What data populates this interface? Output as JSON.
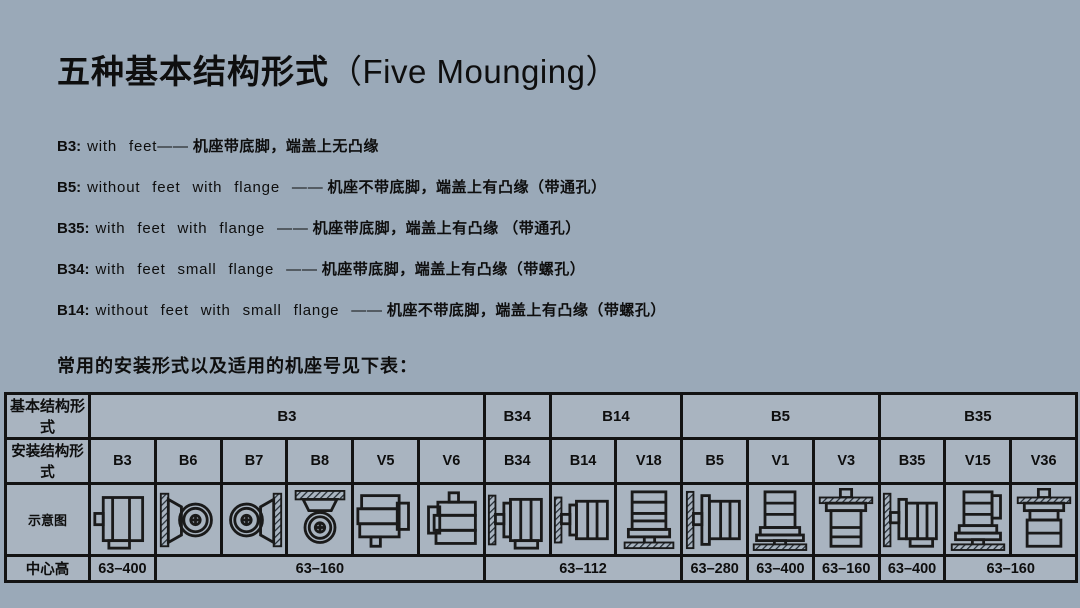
{
  "colors": {
    "background": "#9aa9b8",
    "cell_fill": "#a9b4c0",
    "border": "#131313",
    "text": "#0e0e0e"
  },
  "header": {
    "title_zh": "五种基本结构形式",
    "title_en": "（Five Mounging）"
  },
  "definitions": [
    {
      "code": "B3:",
      "en": "with  feet——",
      "zh": "机座带底脚，端盖上无凸缘"
    },
    {
      "code": "B5:",
      "en": "without  feet  with  flange ——",
      "zh": "机座不带底脚，端盖上有凸缘（带通孔）"
    },
    {
      "code": "B35:",
      "en": "with  feet  with  flange ——",
      "zh": "机座带底脚，端盖上有凸缘 （带通孔）"
    },
    {
      "code": "B34:",
      "en": "with  feet  small  flange ——",
      "zh": "机座带底脚，端盖上有凸缘（带螺孔）"
    },
    {
      "code": "B14:",
      "en": "without  feet  with  small  flange ——",
      "zh": "机座不带底脚，端盖上有凸缘（带螺孔）"
    }
  ],
  "subtitle": "常用的安装形式以及适用的机座号见下表：",
  "table": {
    "row_labels": [
      "基本结构形式",
      "安装结构形式",
      "示意图",
      "中心高"
    ],
    "groups": [
      {
        "label": "B3",
        "span": 6
      },
      {
        "label": "B34",
        "span": 1
      },
      {
        "label": "B14",
        "span": 2
      },
      {
        "label": "B5",
        "span": 3
      },
      {
        "label": "B35",
        "span": 3
      }
    ],
    "mount_forms": [
      "B3",
      "B6",
      "B7",
      "B8",
      "V5",
      "V6",
      "B34",
      "B14",
      "V18",
      "B5",
      "V1",
      "V3",
      "B35",
      "V15",
      "V36"
    ],
    "diagrams": [
      {
        "form": "B3",
        "icon": "motor-side-feet-icon"
      },
      {
        "form": "B6",
        "icon": "motor-end-wall-left-icon"
      },
      {
        "form": "B7",
        "icon": "motor-end-wall-right-icon"
      },
      {
        "form": "B8",
        "icon": "motor-end-ceiling-icon"
      },
      {
        "form": "V5",
        "icon": "motor-vertical-shaft-down-icon"
      },
      {
        "form": "V6",
        "icon": "motor-vertical-shaft-up-icon"
      },
      {
        "form": "B34",
        "icon": "motor-wall-small-flange-feet-icon"
      },
      {
        "form": "B14",
        "icon": "motor-wall-small-flange-icon"
      },
      {
        "form": "V18",
        "icon": "motor-flange-down-floor-icon"
      },
      {
        "form": "B5",
        "icon": "motor-wall-flange-icon"
      },
      {
        "form": "V1",
        "icon": "motor-flange-down-shaft-down-icon"
      },
      {
        "form": "V3",
        "icon": "motor-flange-up-shaft-up-icon"
      },
      {
        "form": "B35",
        "icon": "motor-wall-flange-feet-icon"
      },
      {
        "form": "V15",
        "icon": "motor-flange-feet-down-icon"
      },
      {
        "form": "V36",
        "icon": "motor-flange-feet-up-icon"
      }
    ],
    "center_heights": [
      {
        "value": "63–400",
        "span": 1
      },
      {
        "value": "63–160",
        "span": 5
      },
      {
        "value": "63–112",
        "span": 3
      },
      {
        "value": "63–280",
        "span": 1
      },
      {
        "value": "63–400",
        "span": 1
      },
      {
        "value": "63–160",
        "span": 1
      },
      {
        "value": "63–400",
        "span": 1
      },
      {
        "value": "63–160",
        "span": 2
      }
    ]
  }
}
